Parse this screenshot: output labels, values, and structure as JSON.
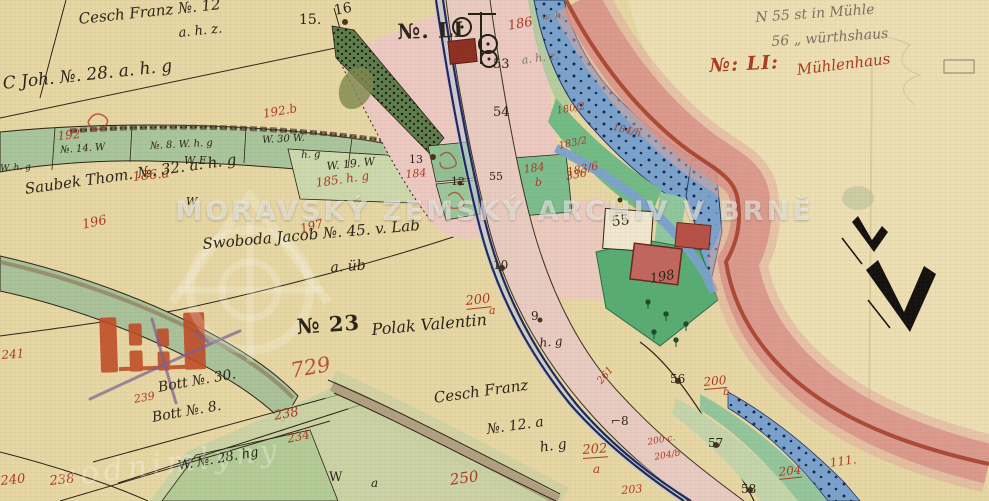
{
  "map": {
    "watermarks": {
      "archive": "MORAVSKÝ ZEMSKÝ ARCHIV V BRNĚ",
      "site": "vodnimlyny"
    },
    "colors": {
      "paper": "#e7d7a5",
      "black_ink": "#2b2418",
      "red_ink": "#ad3a22",
      "water_blue": "#7aa2ce",
      "meadow_green": "#a9c59c",
      "garden_green": "#57ad74",
      "village_pink": "#ecc9c3",
      "boundary_red": "#d9938a",
      "building_red": "#8e2f23"
    },
    "symbols": {
      "mill": "mill-wheel-symbol",
      "survey": "surveyor-zigzag-mark",
      "stamp": "red-stamp-bars",
      "logo": "water-mill-logo-watermark"
    },
    "labels": [
      {
        "t": "Cesch Franz №. 12"
      },
      {
        "t": "a. h. z."
      },
      {
        "t": "15."
      },
      {
        "t": "16"
      },
      {
        "t": "C Joh. №. 28. a. h. g"
      },
      {
        "t": "192.b"
      },
      {
        "t": "192"
      },
      {
        "t": "№. 14. W"
      },
      {
        "t": "№. 8. W. h. g"
      },
      {
        "t": "W. 30 W."
      },
      {
        "t": "h. g"
      },
      {
        "t": "186.a"
      },
      {
        "t": "W E"
      },
      {
        "t": "Saubek Thom. №. 32. a. h. g"
      },
      {
        "t": "W"
      },
      {
        "t": "196"
      },
      {
        "t": "W. 19. W"
      },
      {
        "t": "185. h. g"
      },
      {
        "t": "197"
      },
      {
        "t": "13"
      },
      {
        "t": "184"
      },
      {
        "t": "12"
      },
      {
        "t": "55"
      },
      {
        "t": "184"
      },
      {
        "t": "b"
      },
      {
        "t": "336"
      },
      {
        "t": "№. LI"
      },
      {
        "t": "186"
      },
      {
        "t": "53"
      },
      {
        "t": "54"
      },
      {
        "t": "a. h. z."
      },
      {
        "t": "180/2"
      },
      {
        "t": "183/2"
      },
      {
        "t": "184/h"
      },
      {
        "t": "183/6"
      },
      {
        "t": "Swoboda Jacob №. 45. v. Lab"
      },
      {
        "t": "a. üb"
      },
      {
        "t": "10"
      },
      {
        "t": "200"
      },
      {
        "t": "a"
      },
      {
        "t": "№ 23"
      },
      {
        "t": "Polak Valentin"
      },
      {
        "t": "h. g"
      },
      {
        "t": "9"
      },
      {
        "t": "55"
      },
      {
        "t": "198"
      },
      {
        "t": "56"
      },
      {
        "t": "200"
      },
      {
        "t": "b"
      },
      {
        "t": "57"
      },
      {
        "t": "⌐8"
      },
      {
        "t": "202"
      },
      {
        "t": "a"
      },
      {
        "t": "204"
      },
      {
        "t": "111."
      },
      {
        "t": "203"
      },
      {
        "t": "58"
      },
      {
        "t": "200 c."
      },
      {
        "t": "204/b"
      },
      {
        "t": "261"
      },
      {
        "t": "Cesch Franz"
      },
      {
        "t": "№. 12. a"
      },
      {
        "t": "h. g"
      },
      {
        "t": "250"
      },
      {
        "t": "W"
      },
      {
        "t": "a"
      },
      {
        "t": "241"
      },
      {
        "t": "239"
      },
      {
        "t": "Bott №. 30."
      },
      {
        "t": "Bott №. 8."
      },
      {
        "t": "238"
      },
      {
        "t": "234"
      },
      {
        "t": "W. №. 28. hg"
      },
      {
        "t": "240"
      },
      {
        "t": "238"
      },
      {
        "t": "729"
      },
      {
        "t": "N 55 st in Mühle"
      },
      {
        "t": "56 „ würthshaus"
      },
      {
        "t": "№: LI:"
      },
      {
        "t": "Mühlenhaus"
      },
      {
        "t": "W. h. g"
      },
      {
        "t": "w. h."
      }
    ]
  }
}
